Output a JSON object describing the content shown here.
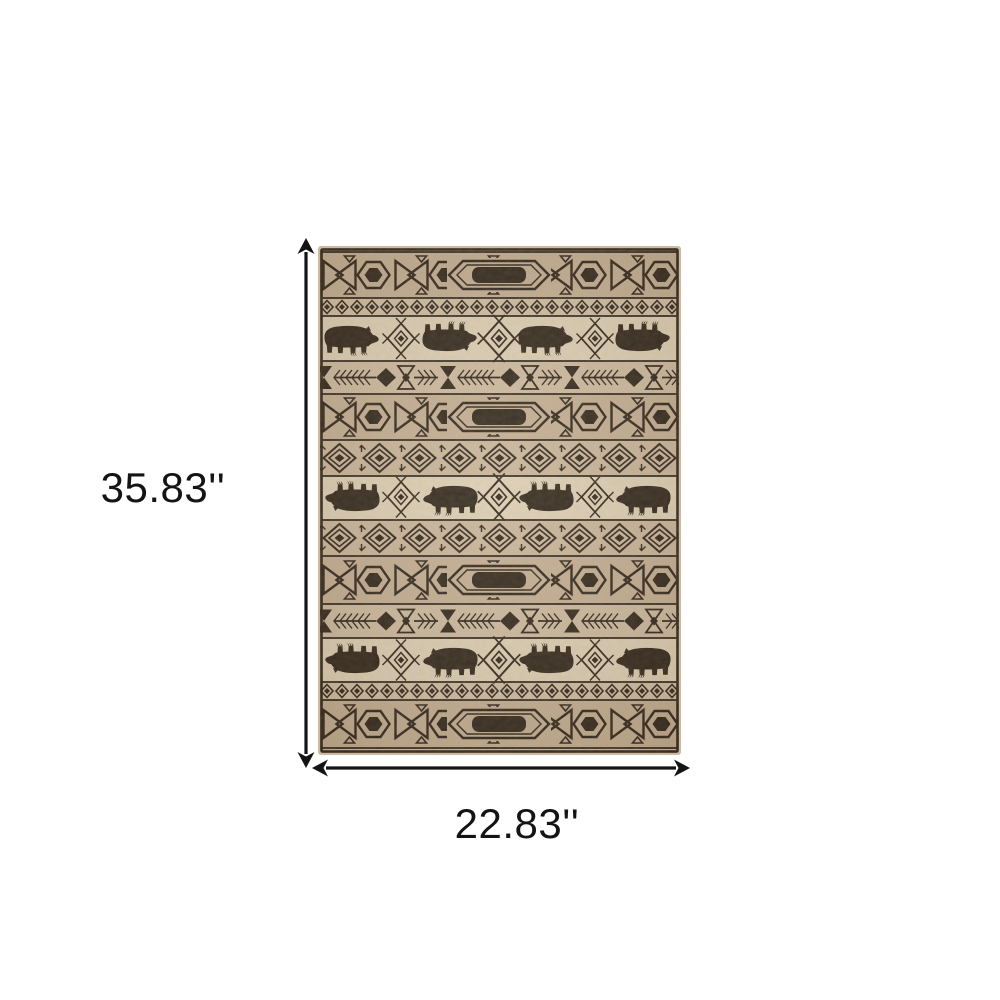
{
  "page": {
    "type": "product-dimension-diagram"
  },
  "image": {
    "alt": "beige-and-black-lodge-area-rug-with-bear-and-geometric-pattern"
  },
  "dimensions": {
    "height_label": "35.83''",
    "width_label": "22.83''"
  },
  "icons": {
    "vertical_arrow": "double-headed-vertical-dimension-arrow",
    "horizontal_arrow": "double-headed-horizontal-dimension-arrow"
  },
  "colors": {
    "background": "#ffffff",
    "arrow": "#141414",
    "text": "#141414",
    "rug_base": "#cdbaa0",
    "rug_dark": "#2a2014",
    "rug_hexband": "#c2ad90",
    "rug_lightband": "#ddcfb3",
    "rug_sdband": "#cfbda1",
    "rug_arrowband": "#ccb99d",
    "rug_mdband": "#c8b498",
    "rug_edge": "#9b8468"
  }
}
